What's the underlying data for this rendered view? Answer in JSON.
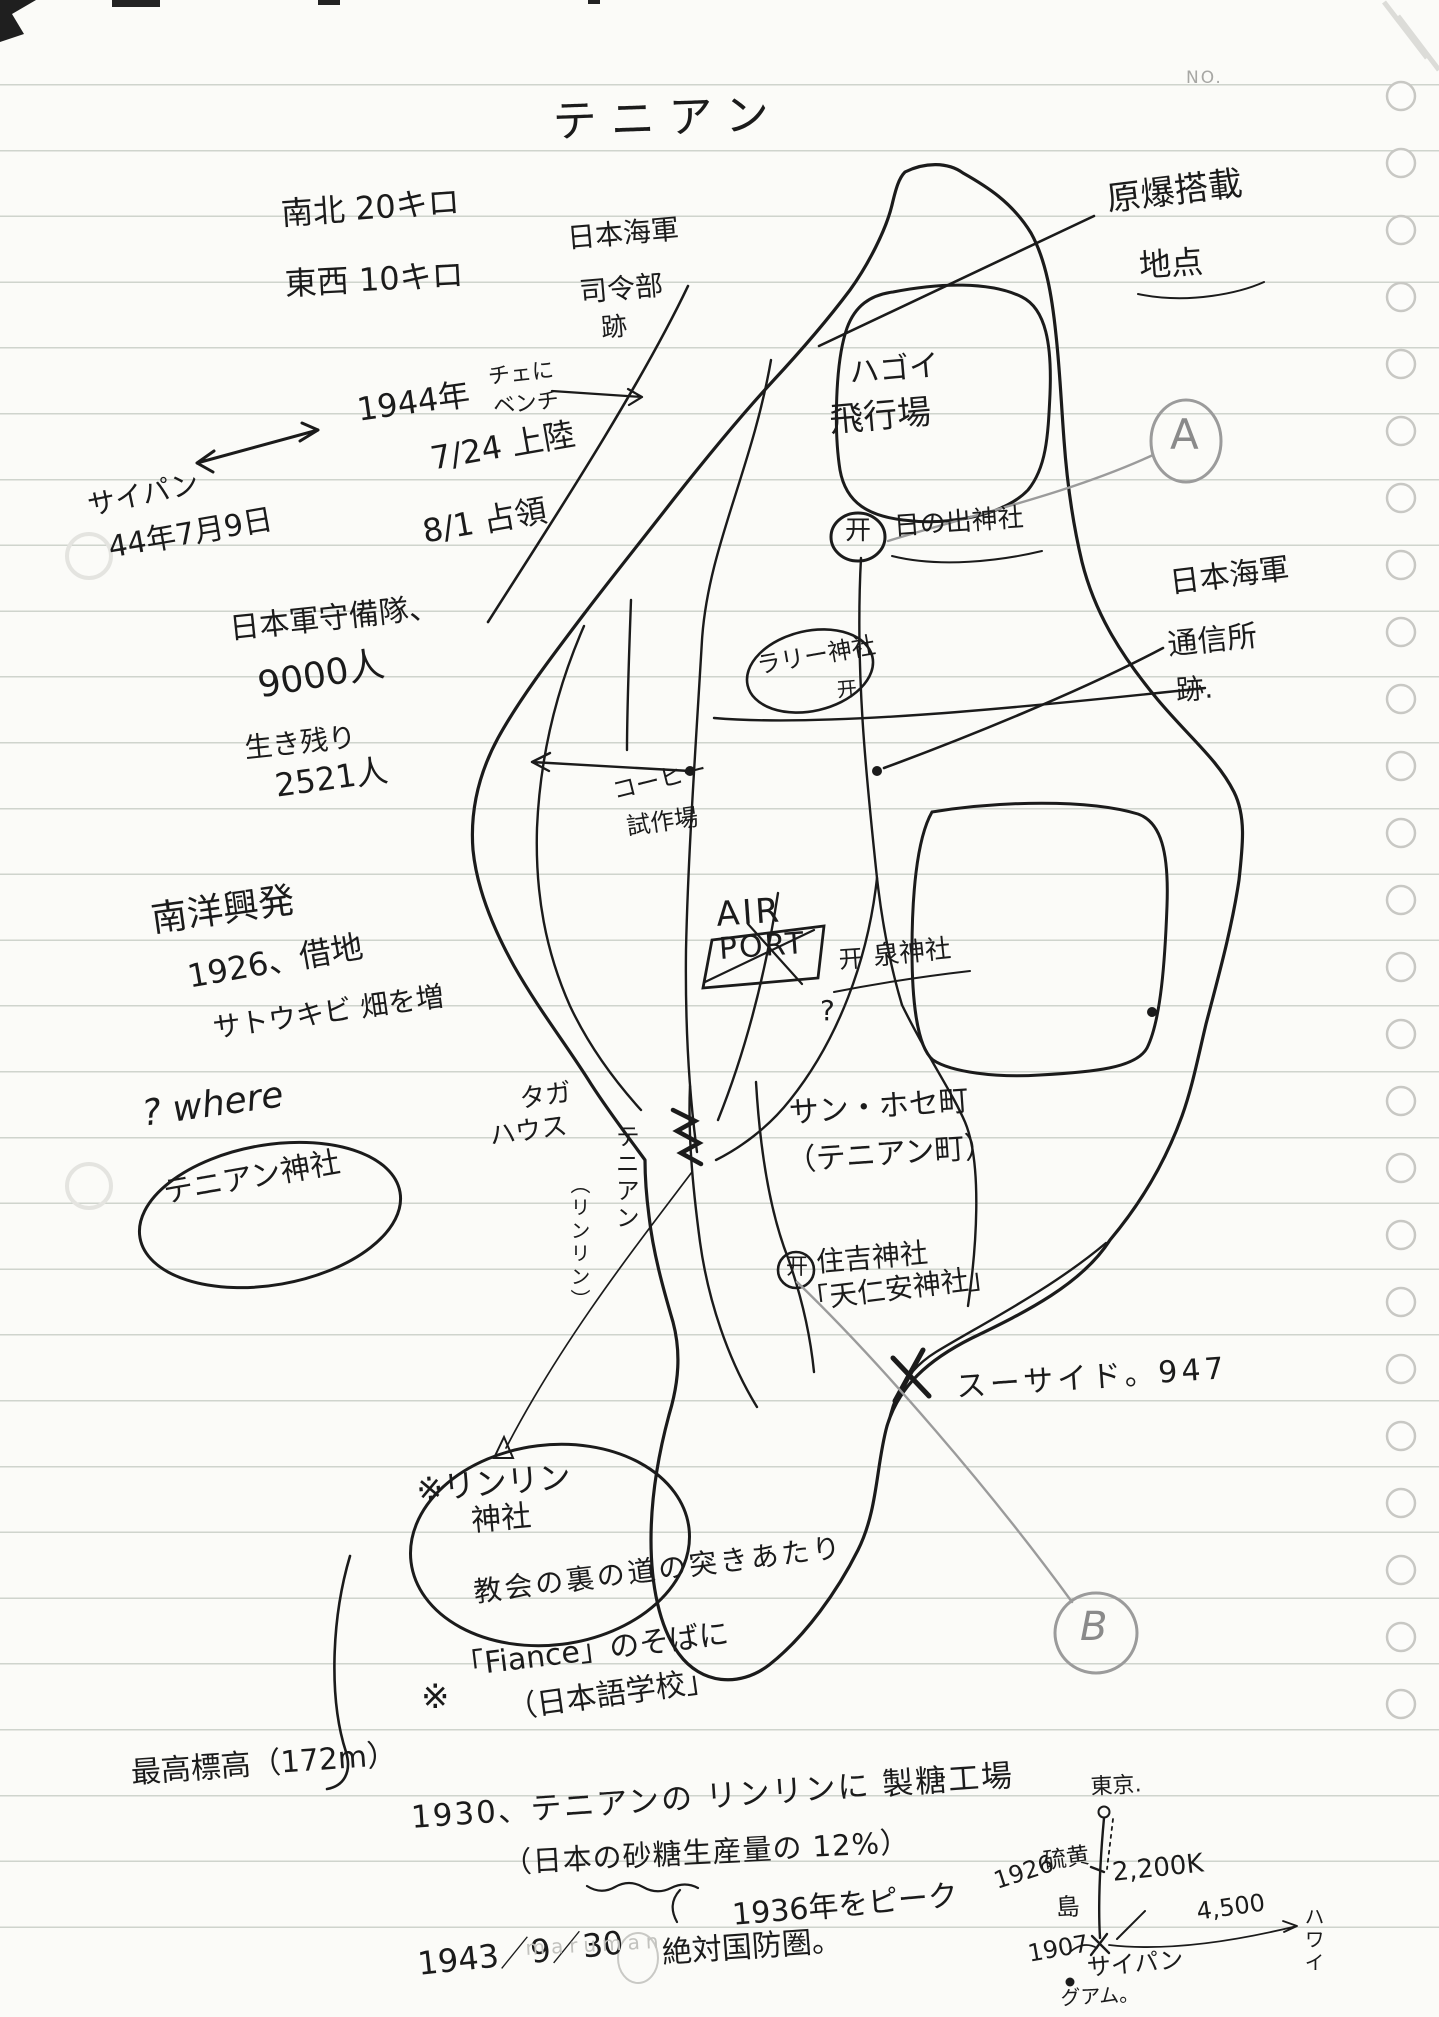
{
  "colors": {
    "ink": "#1b1b1b",
    "pencil": "#9b9b9b",
    "paper": "#fbfbf8"
  },
  "page": {
    "no_label": "NO.",
    "watermark": "maruman",
    "title": "テニアン"
  },
  "notes": {
    "size": [
      "南北 20キロ",
      "東西 10キロ"
    ],
    "navy_hq": [
      "日本海軍",
      "司令部",
      "跡"
    ],
    "bench": [
      "チェに",
      "ベンチ"
    ],
    "abomb": [
      "原爆搭載",
      "地点"
    ],
    "landing": [
      "1944年",
      "7/24 上陸",
      "8/1 占領"
    ],
    "saipan": [
      "サイパン",
      "44年7月9日"
    ],
    "garrison": [
      "日本軍守備隊、",
      "9000人",
      "生き残り",
      "2521人"
    ],
    "navy_comm": [
      "日本海軍",
      "通信所",
      "跡."
    ],
    "coffee": [
      "コーヒー",
      "試作場"
    ],
    "sugar_company": [
      "南洋興発",
      "1926、借地",
      "サトウキビ 畑を増"
    ],
    "where": "? where",
    "tinian_shrine": "テニアン神社",
    "church": "教会の裏の道の突きあたり",
    "fiance_mark": "※",
    "fiance": [
      "「Fiance」のそばに",
      "（日本語学校」"
    ],
    "elevation": "最高標高（172m）",
    "sugar_mill": "1930、テニアンの リンリンに 製糖工場",
    "sugar_share": "（日本の砂糖生産量の 12%）",
    "peak": "1936年をピーク",
    "defense": [
      "1943／9／30",
      "絶対国防圏。"
    ]
  },
  "map": {
    "torii_glyph": "开",
    "marker_a": "A",
    "marker_b": "B",
    "airfield": [
      "ハゴイ",
      "飛行場"
    ],
    "hinode_shrine": "日の出神社",
    "rally_shrine": "ラリー神社",
    "izumi_shrine": "泉神社",
    "izumi_question": "?",
    "airport": [
      "AIR",
      "PORT"
    ],
    "taga": [
      "タガ",
      "ハウス"
    ],
    "tinian_vertical": "テニアン",
    "rinrin_vertical": "（リンリン）",
    "san_jose": [
      "サン・ホセ町",
      "（テニアン町）"
    ],
    "sumiyoshi": [
      "住吉神社",
      "「天仁安神社」"
    ],
    "suicide": "スーサイド。947",
    "rinrin_shrine": [
      "※リンリン",
      "神社"
    ]
  },
  "route_sketch": {
    "tokyo": "東京.",
    "iwojima_1": "硫黄",
    "iwojima_2": "島",
    "year_1926": "1926",
    "distance_tokyo": "2,200K",
    "saipan": "サイパン",
    "year_1907": "1907",
    "guam": "グアム。",
    "distance_east": "4,500",
    "hawaii": "ハワイ"
  }
}
